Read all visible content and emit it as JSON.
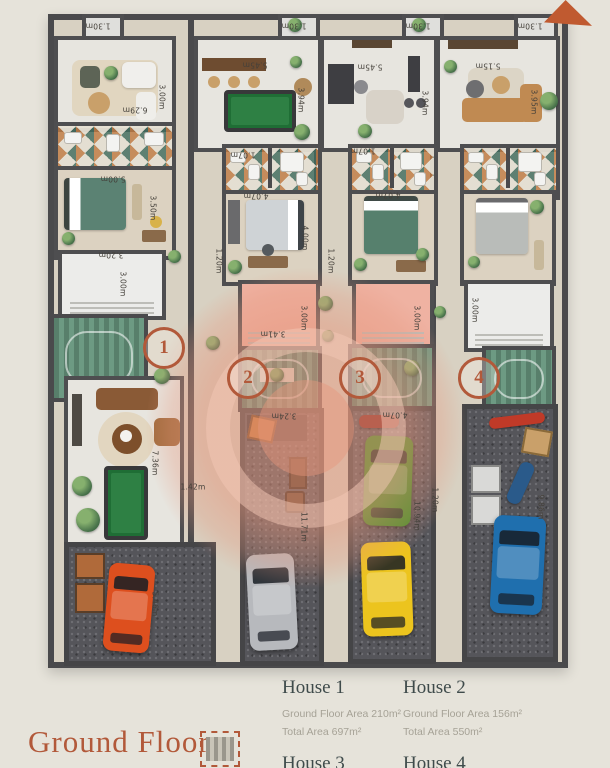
{
  "legend": {
    "title": "Ground Floor",
    "houses": [
      {
        "name": "House 1",
        "area_line": "Ground Floor Area 210m²",
        "total_line": "Total Area 697m²"
      },
      {
        "name": "House 2",
        "area_line": "Ground Floor Area 156m²",
        "total_line": "Total Area 550m²"
      },
      {
        "name": "House 3"
      },
      {
        "name": "House 4"
      }
    ]
  },
  "plan": {
    "markers": [
      {
        "label": "1",
        "x": 161,
        "y": 345
      },
      {
        "label": "2",
        "x": 245,
        "y": 375
      },
      {
        "label": "3",
        "x": 357,
        "y": 375
      },
      {
        "label": "4",
        "x": 476,
        "y": 375
      }
    ],
    "dimension_labels": [
      {
        "text": "1.30m",
        "x": 98,
        "y": 26,
        "rot": 180
      },
      {
        "text": "1.30m",
        "x": 294,
        "y": 26,
        "rot": 180
      },
      {
        "text": "1.30m",
        "x": 418,
        "y": 26,
        "rot": 180
      },
      {
        "text": "1.30m",
        "x": 530,
        "y": 26,
        "rot": 180
      },
      {
        "text": "6.29m",
        "x": 135,
        "y": 110,
        "rot": 180
      },
      {
        "text": "3.00m",
        "x": 162,
        "y": 97,
        "rot": 90
      },
      {
        "text": "5.45m",
        "x": 255,
        "y": 65,
        "rot": 180
      },
      {
        "text": "3.94m",
        "x": 301,
        "y": 100,
        "rot": 90
      },
      {
        "text": "5.45m",
        "x": 370,
        "y": 67,
        "rot": 180
      },
      {
        "text": "3.94m",
        "x": 425,
        "y": 103,
        "rot": 90
      },
      {
        "text": "5.15m",
        "x": 488,
        "y": 66,
        "rot": 180
      },
      {
        "text": "3.95m",
        "x": 534,
        "y": 102,
        "rot": 90
      },
      {
        "text": "5.00m",
        "x": 113,
        "y": 179,
        "rot": 180
      },
      {
        "text": "3.50m",
        "x": 153,
        "y": 208,
        "rot": 90
      },
      {
        "text": "1.07m",
        "x": 243,
        "y": 155,
        "rot": 180
      },
      {
        "text": "1.07m",
        "x": 363,
        "y": 151,
        "rot": 180
      },
      {
        "text": "4.07m",
        "x": 256,
        "y": 196,
        "rot": 180
      },
      {
        "text": "4.00m",
        "x": 305,
        "y": 238,
        "rot": 90
      },
      {
        "text": "4.07m",
        "x": 388,
        "y": 195,
        "rot": 180
      },
      {
        "text": "1.20m",
        "x": 219,
        "y": 261,
        "rot": 90
      },
      {
        "text": "1.20m",
        "x": 331,
        "y": 261,
        "rot": 90
      },
      {
        "text": "3.20m",
        "x": 111,
        "y": 255,
        "rot": 180
      },
      {
        "text": "3.00m",
        "x": 123,
        "y": 284,
        "rot": 90
      },
      {
        "text": "3.41m",
        "x": 273,
        "y": 334,
        "rot": 180
      },
      {
        "text": "3.00m",
        "x": 304,
        "y": 318,
        "rot": 90
      },
      {
        "text": "3.00m",
        "x": 417,
        "y": 318,
        "rot": 90
      },
      {
        "text": "3.00m",
        "x": 475,
        "y": 310,
        "rot": 90
      },
      {
        "text": "7.36m",
        "x": 155,
        "y": 463,
        "rot": 90
      },
      {
        "text": "1.42m",
        "x": 193,
        "y": 487,
        "rot": 0
      },
      {
        "text": "5.46m",
        "x": 155,
        "y": 604,
        "rot": 90
      },
      {
        "text": "3.24m",
        "x": 284,
        "y": 416,
        "rot": 180
      },
      {
        "text": "4.07m",
        "x": 395,
        "y": 415,
        "rot": 180
      },
      {
        "text": "11.71m",
        "x": 304,
        "y": 527,
        "rot": 90
      },
      {
        "text": "10.94m",
        "x": 417,
        "y": 516,
        "rot": 90
      },
      {
        "text": "9.86m",
        "x": 541,
        "y": 507,
        "rot": 90
      },
      {
        "text": "1.20m",
        "x": 435,
        "y": 500,
        "rot": 90
      }
    ],
    "cars": [
      {
        "name": "orange-car",
        "color": "#dd4f1e",
        "x": 106,
        "y": 564,
        "w": 46,
        "h": 88,
        "rot": 5
      },
      {
        "name": "silver-car",
        "color": "#b7b9bd",
        "x": 248,
        "y": 554,
        "w": 48,
        "h": 96,
        "rot": -3
      },
      {
        "name": "green-car",
        "color": "#3f8d25",
        "x": 364,
        "y": 436,
        "w": 48,
        "h": 90,
        "rot": 2
      },
      {
        "name": "yellow-car",
        "color": "#ecc41e",
        "x": 362,
        "y": 542,
        "w": 50,
        "h": 94,
        "rot": -2
      },
      {
        "name": "blue-car",
        "color": "#1f6fae",
        "x": 492,
        "y": 516,
        "w": 52,
        "h": 98,
        "rot": 3
      }
    ]
  },
  "colors": {
    "accent": "#b2593a",
    "wall": "#4a4a4c",
    "terrace-pink": "#efb2a2",
    "watermark": "#e69e83",
    "heading": "#3f4b4b",
    "muted": "#a6a296"
  }
}
